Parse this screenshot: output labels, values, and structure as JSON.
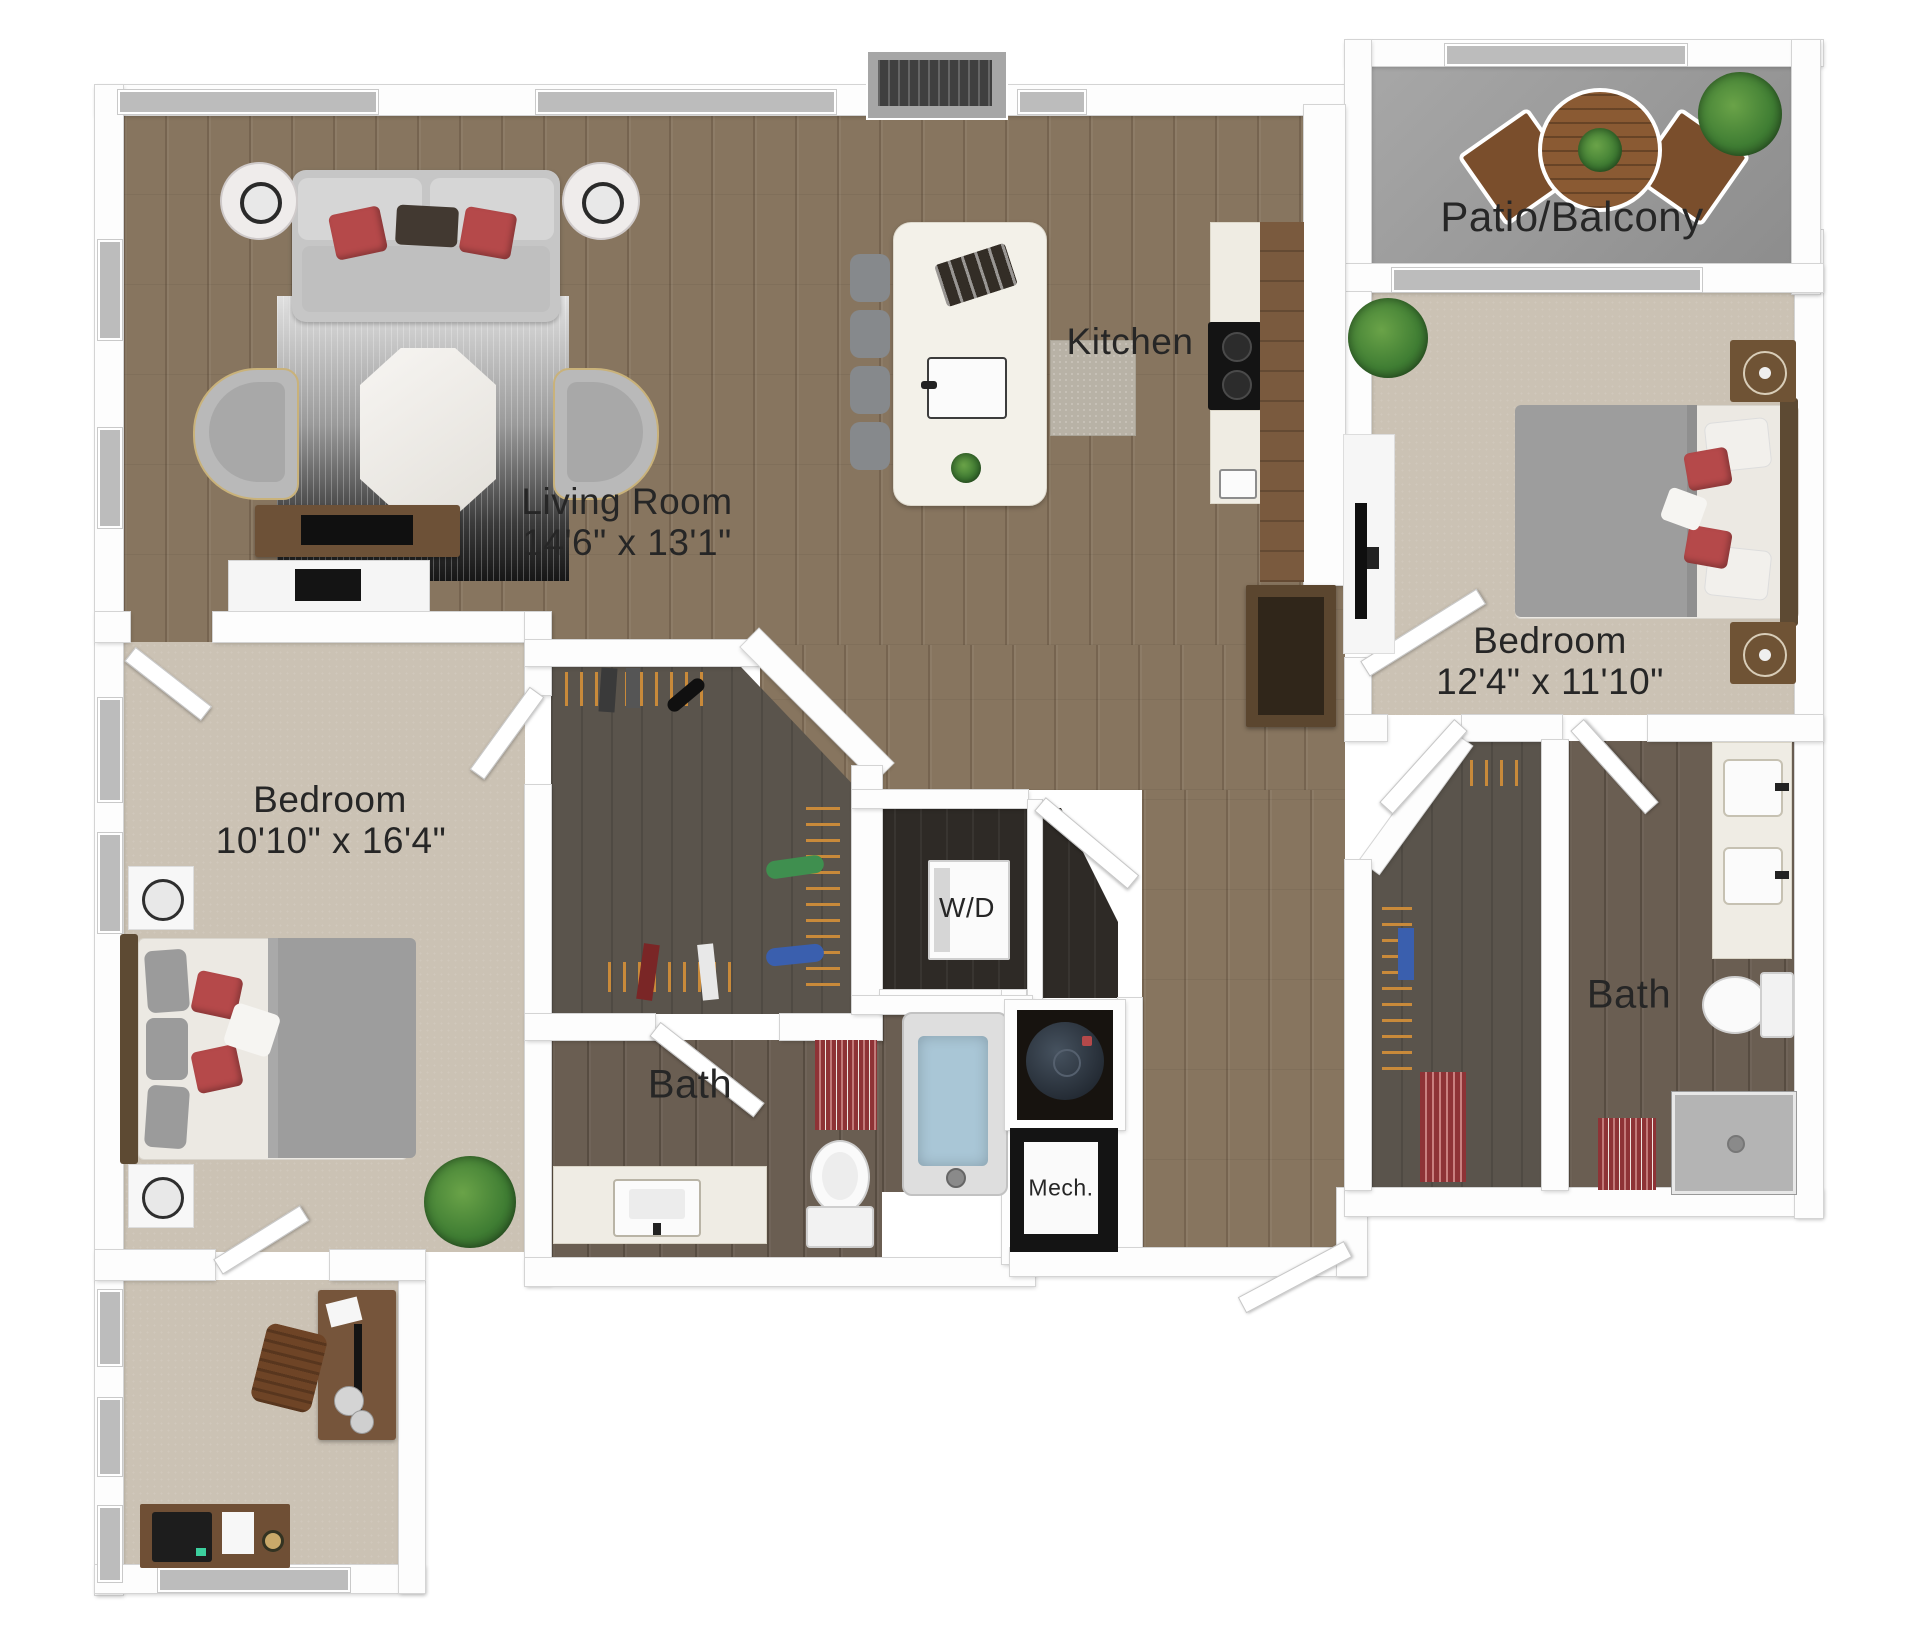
{
  "floorplan": {
    "living_room": {
      "label": "Living Room",
      "dims": "14'6\" x 13'1\""
    },
    "kitchen": {
      "label": "Kitchen"
    },
    "patio": {
      "label": "Patio/Balcony"
    },
    "bedroom_right": {
      "label": "Bedroom",
      "dims": "12'4\" x 11'10\""
    },
    "bedroom_left": {
      "label": "Bedroom",
      "dims": "10'10\" x 16'4\""
    },
    "bath_main": {
      "label": "Bath"
    },
    "bath_second": {
      "label": "Bath"
    },
    "laundry": {
      "label": "W/D"
    },
    "mech": {
      "label": "Mech."
    }
  },
  "colors": {
    "wall": "#fdfdfd",
    "wood": "#87755f",
    "wood_dark": "#6a5e52",
    "closet": "#5a544c",
    "dark_floor": "#2e2a26",
    "carpet": "#cbc2b4",
    "concrete": "#9d9d9d",
    "accent_red": "#b5494a",
    "water": "#a9c6d6",
    "plant": "#3f7d33",
    "furn_brown": "#76553b",
    "furn_gray": "#c6c6c6"
  }
}
